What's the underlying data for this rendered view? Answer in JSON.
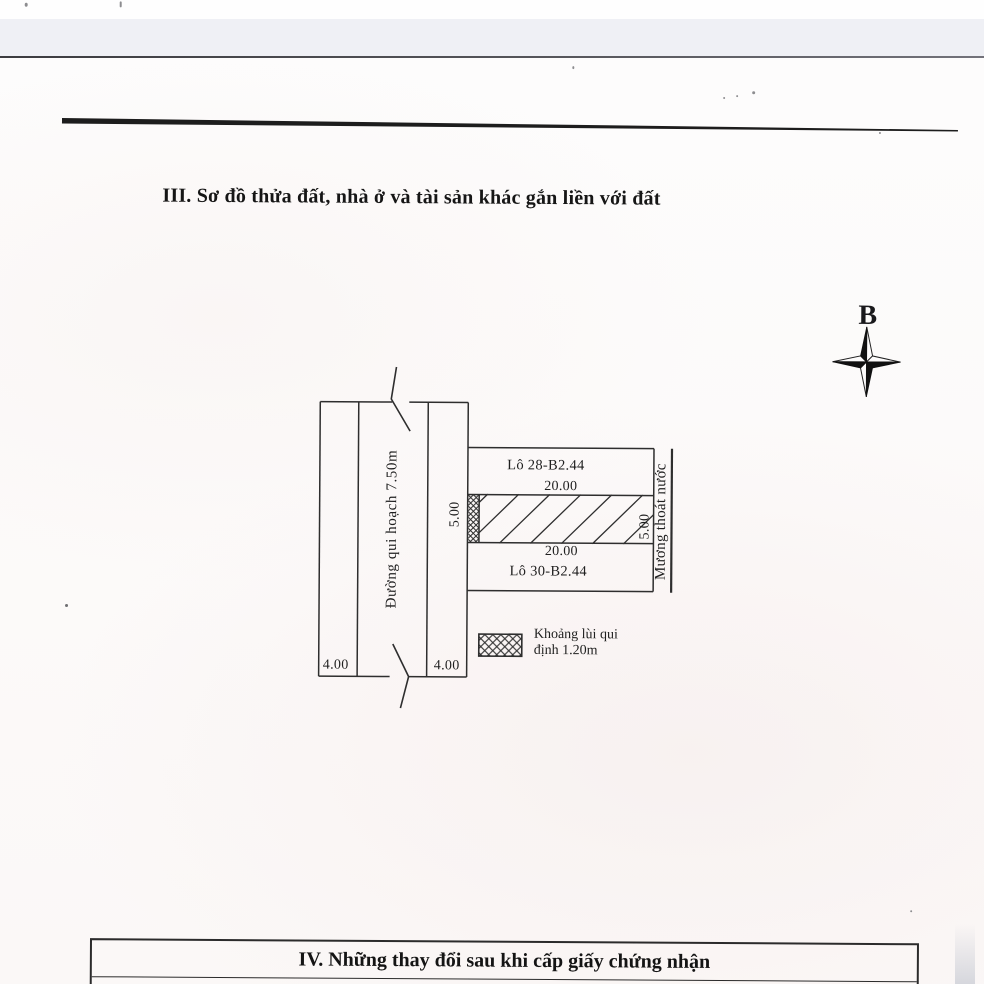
{
  "sections": {
    "iii_title": "III. Sơ đồ thửa đất, nhà ở và tài sản khác gắn liền với đất",
    "iv_title": "IV. Những thay đổi sau khi cấp giấy chứng nhận"
  },
  "compass": {
    "north_label": "B"
  },
  "diagram": {
    "road": {
      "name": "Đường qui hoạch 7.50m",
      "lane_left_width": "4.00",
      "lane_right_width": "4.00",
      "frontage": "5.00"
    },
    "lots": {
      "upper": {
        "name": "Lô 28-B2.44",
        "length": "20.00"
      },
      "lower": {
        "name": "Lô 30-B2.44",
        "length": "20.00"
      },
      "depth": "5.00"
    },
    "drainage": {
      "name": "Mương thoát nước"
    },
    "legend": {
      "label_line1": "Khoảng lùi qui",
      "label_line2": "định 1.20m"
    }
  },
  "colors": {
    "ink": "#2e2e2e",
    "text": "#1b1b1b",
    "paper": "#fbf9f8",
    "scanner_band": "#eff0f5"
  }
}
